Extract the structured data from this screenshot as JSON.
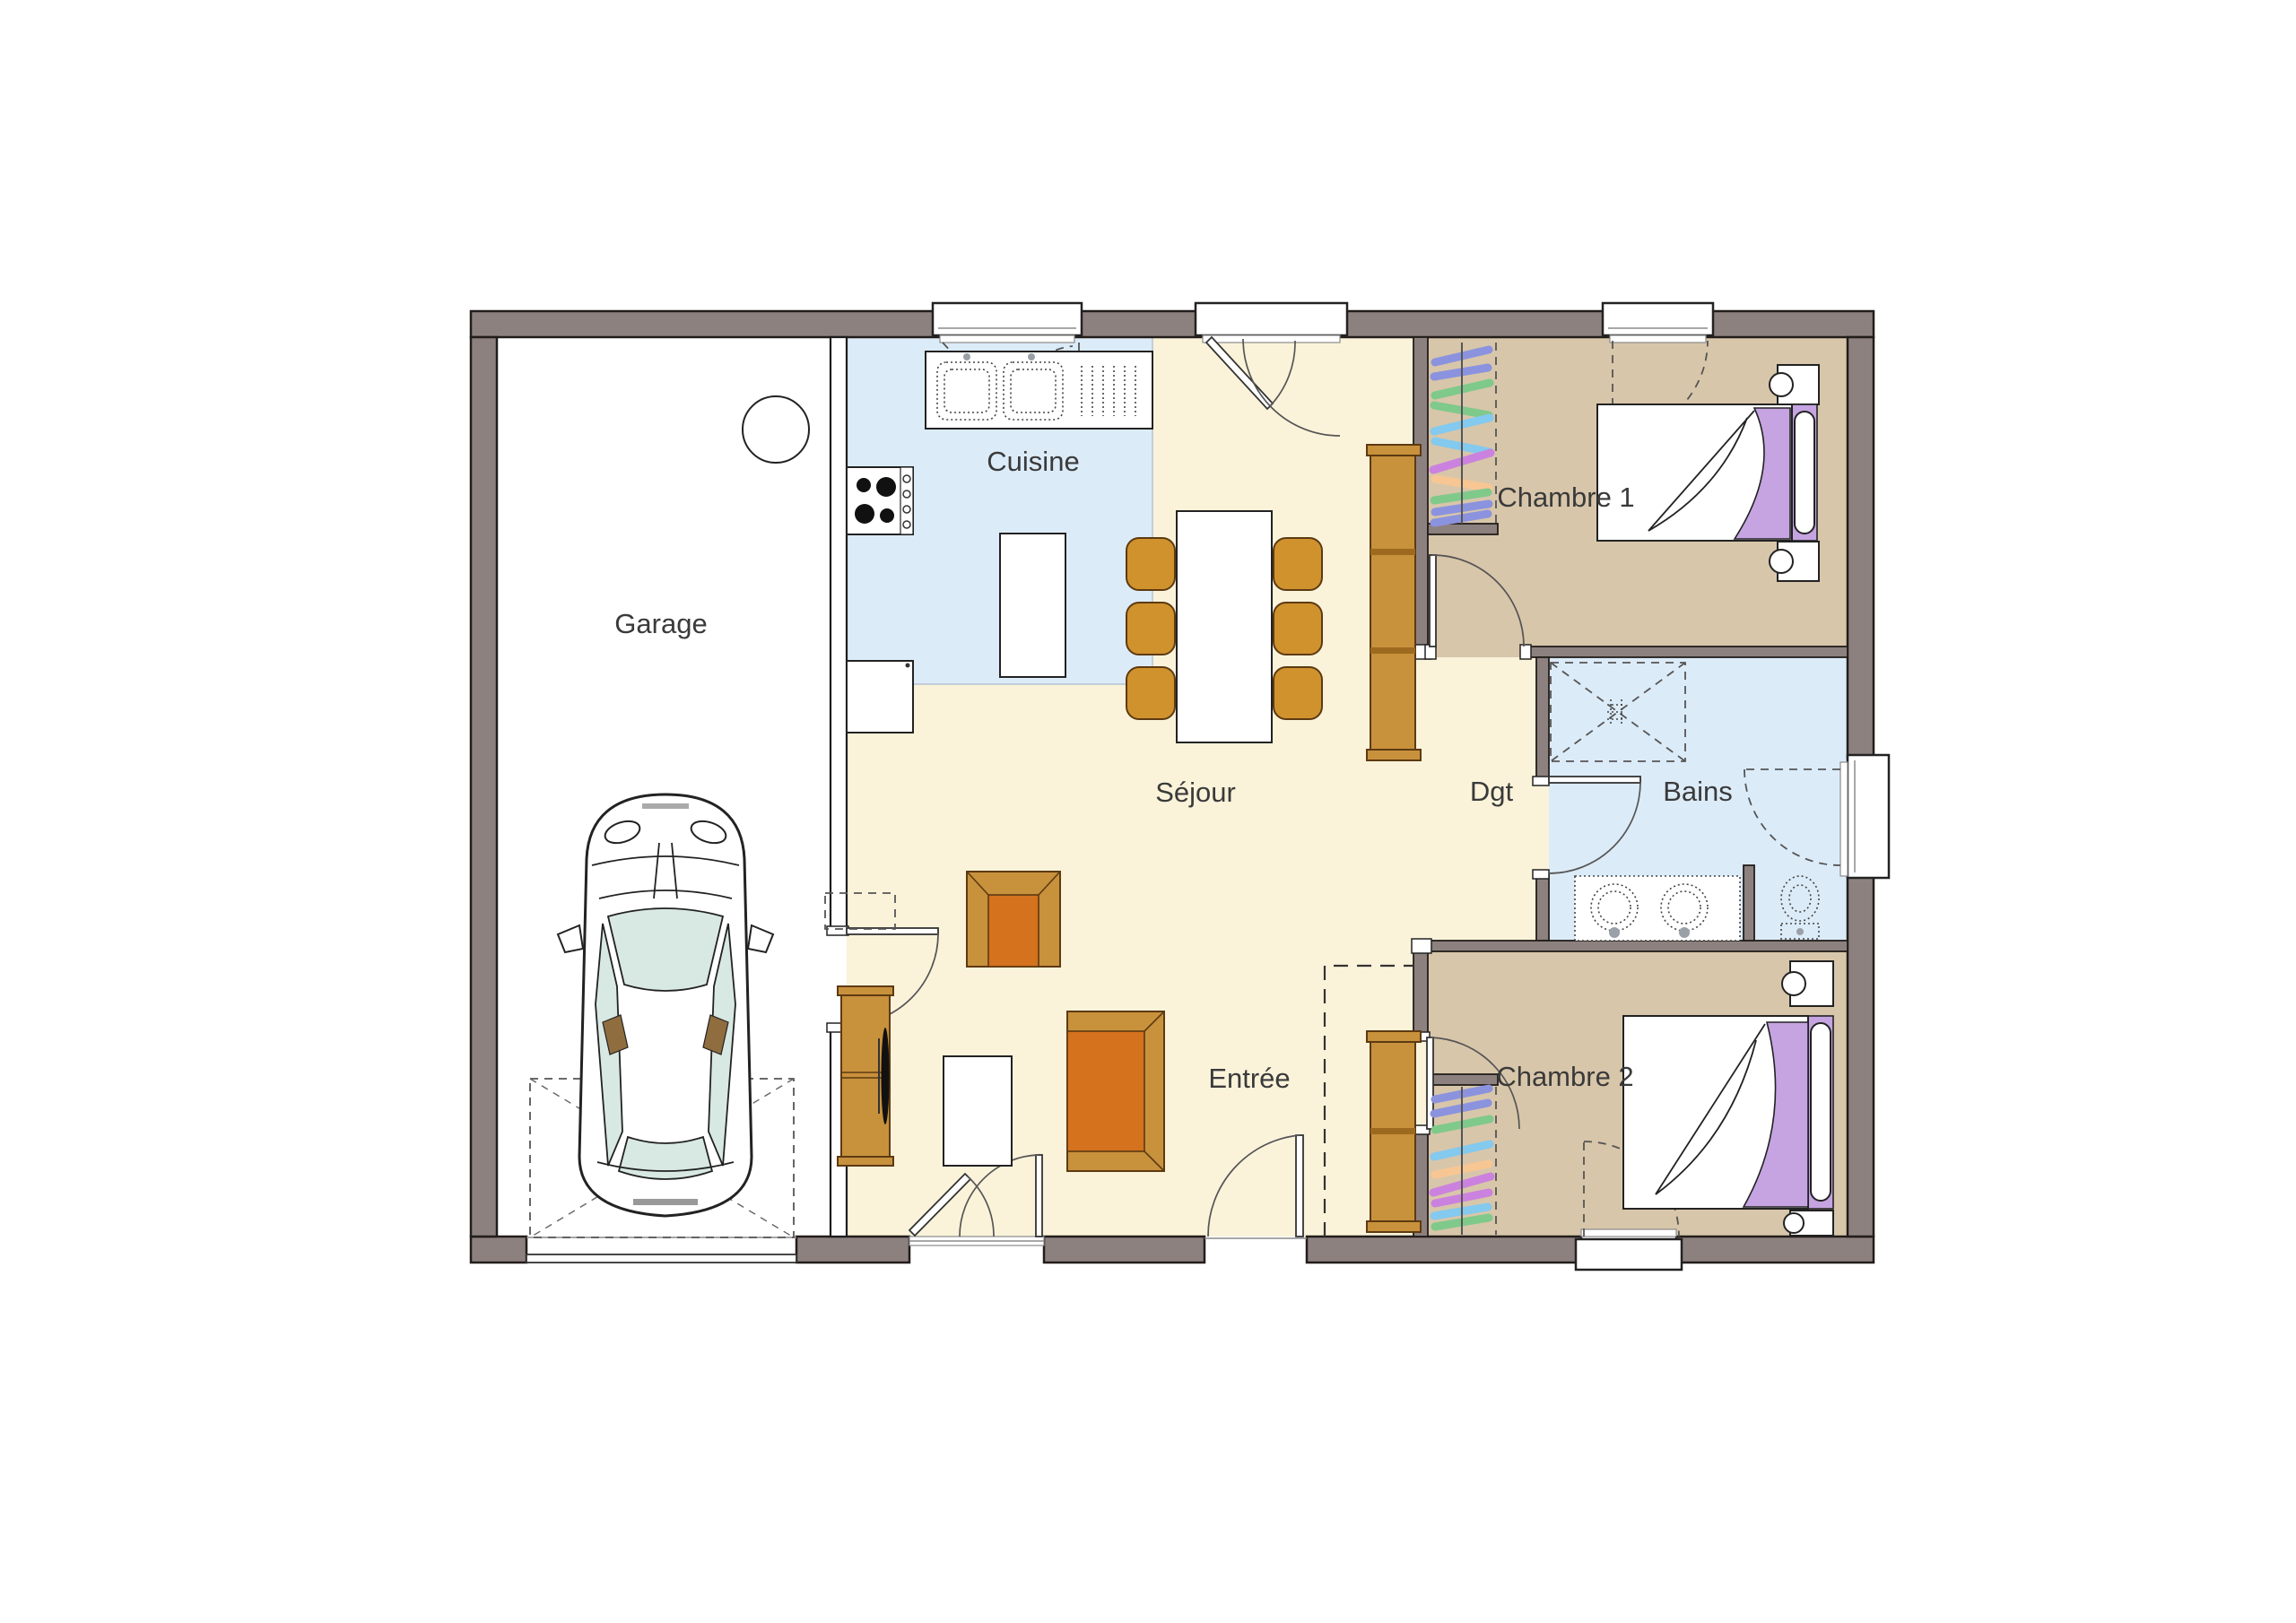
{
  "plan": {
    "type": "floor-plan",
    "background": "#ffffff"
  },
  "rooms": {
    "garage": {
      "label": "Garage"
    },
    "cuisine": {
      "label": "Cuisine"
    },
    "sejour": {
      "label": "Séjour"
    },
    "entree": {
      "label": "Entrée"
    },
    "dgt": {
      "label": "Dgt"
    },
    "bains": {
      "label": "Bains"
    },
    "chambre1": {
      "label": "Chambre 1"
    },
    "chambre2": {
      "label": "Chambre 2"
    }
  },
  "colors": {
    "wall": "#8c817e",
    "wall_outline": "#221d1a",
    "partition": "#ffffff",
    "floor_living": "#faf3da",
    "floor_kitchen": "#dcebf8",
    "floor_bath": "#dcebf8",
    "floor_bedroom": "#d8c6aa",
    "floor_garage": "#ffffff",
    "furniture_orange": "#c8913c",
    "furniture_orange_dark": "#d4721e",
    "furniture_outline": "#5d3a12",
    "chair_orange": "#d0922d",
    "bed_purple": "#c5a4e1",
    "glass": "#d8e8e3",
    "label_text": "#3a3a3a",
    "clothes": {
      "periwinkle": "#8b93de",
      "green": "#7fc98b",
      "cyan": "#84c9ee",
      "magenta": "#cb82de",
      "peach": "#f7c693"
    }
  },
  "furniture_semantics": [
    "car",
    "parking-space",
    "water-heater",
    "sink-counter",
    "stove",
    "fridge",
    "kitchen-island",
    "dining-table",
    "dining-chair",
    "armchair",
    "sofa",
    "coffee-table",
    "tv-cabinet",
    "dresser",
    "wardrobe",
    "bed",
    "nightstand",
    "shower",
    "vanity",
    "toilet",
    "door-swing",
    "window"
  ]
}
